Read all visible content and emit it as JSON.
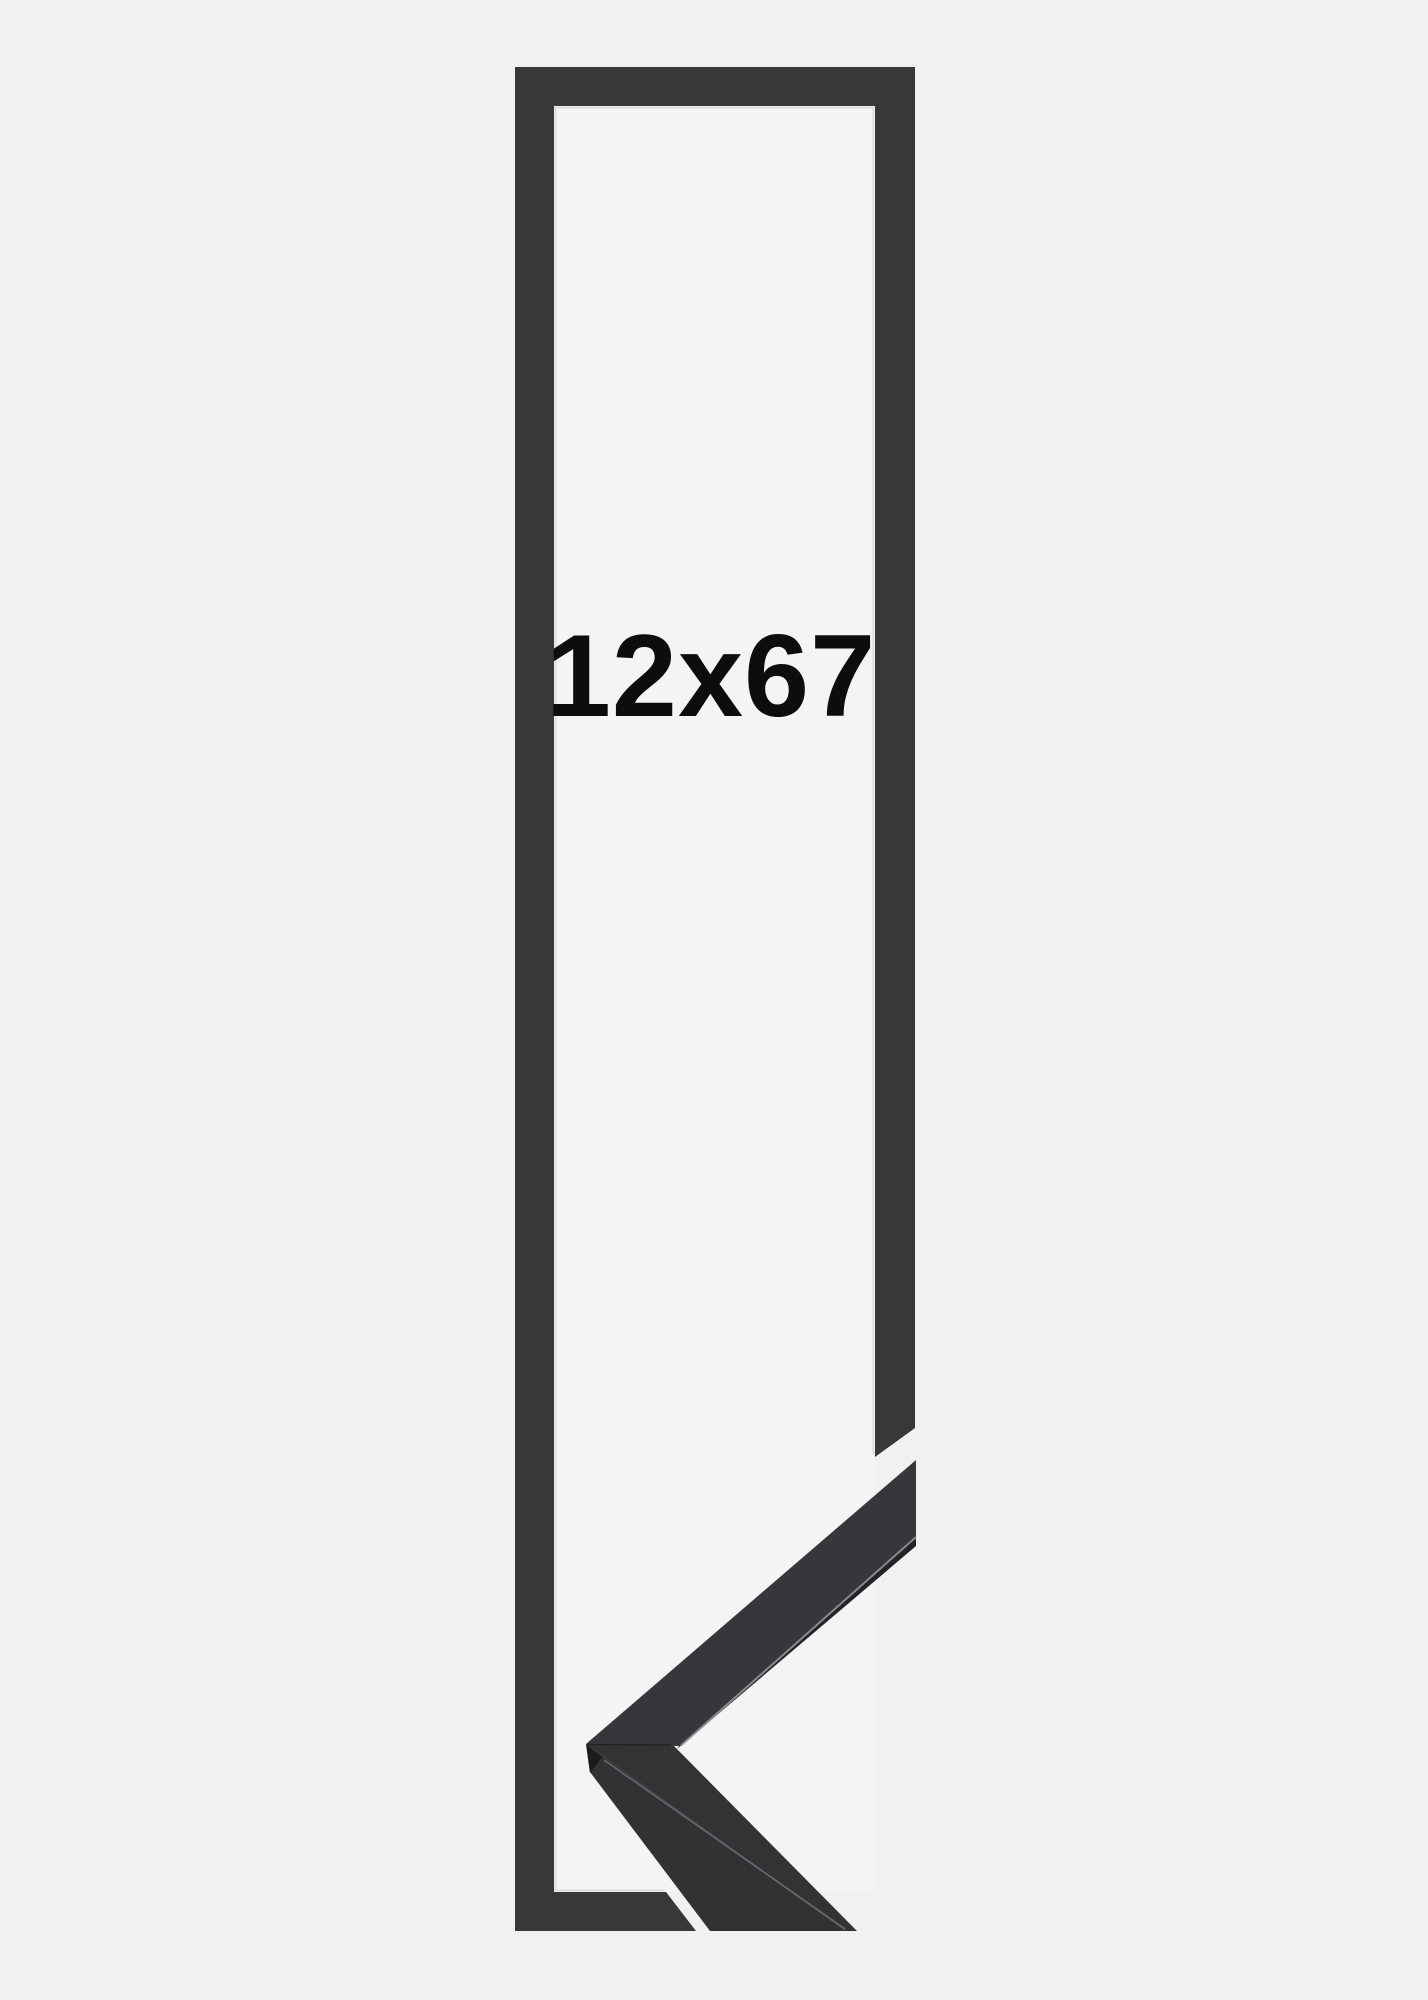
{
  "product": {
    "size_label": "12x67"
  },
  "colors": {
    "background": "#f1f1f2",
    "frame_opening": "#f4f4f5",
    "frame_bar": "#37383a",
    "inner_edge_highlight": "#d2d3d5",
    "moulding_top_face_upper": "#35373a",
    "moulding_lip_upper": "#232427",
    "moulding_top_face_lower": "#313335",
    "moulding_front_face_lower": "#303234",
    "moulding_tip_face": "#1a1b1d",
    "moulding_edge_highlight": "#929396",
    "moulding_ridge_highlight": "#8b8c8f",
    "moulding_miter_seam": "#141517",
    "label": "#0d0d0e"
  }
}
